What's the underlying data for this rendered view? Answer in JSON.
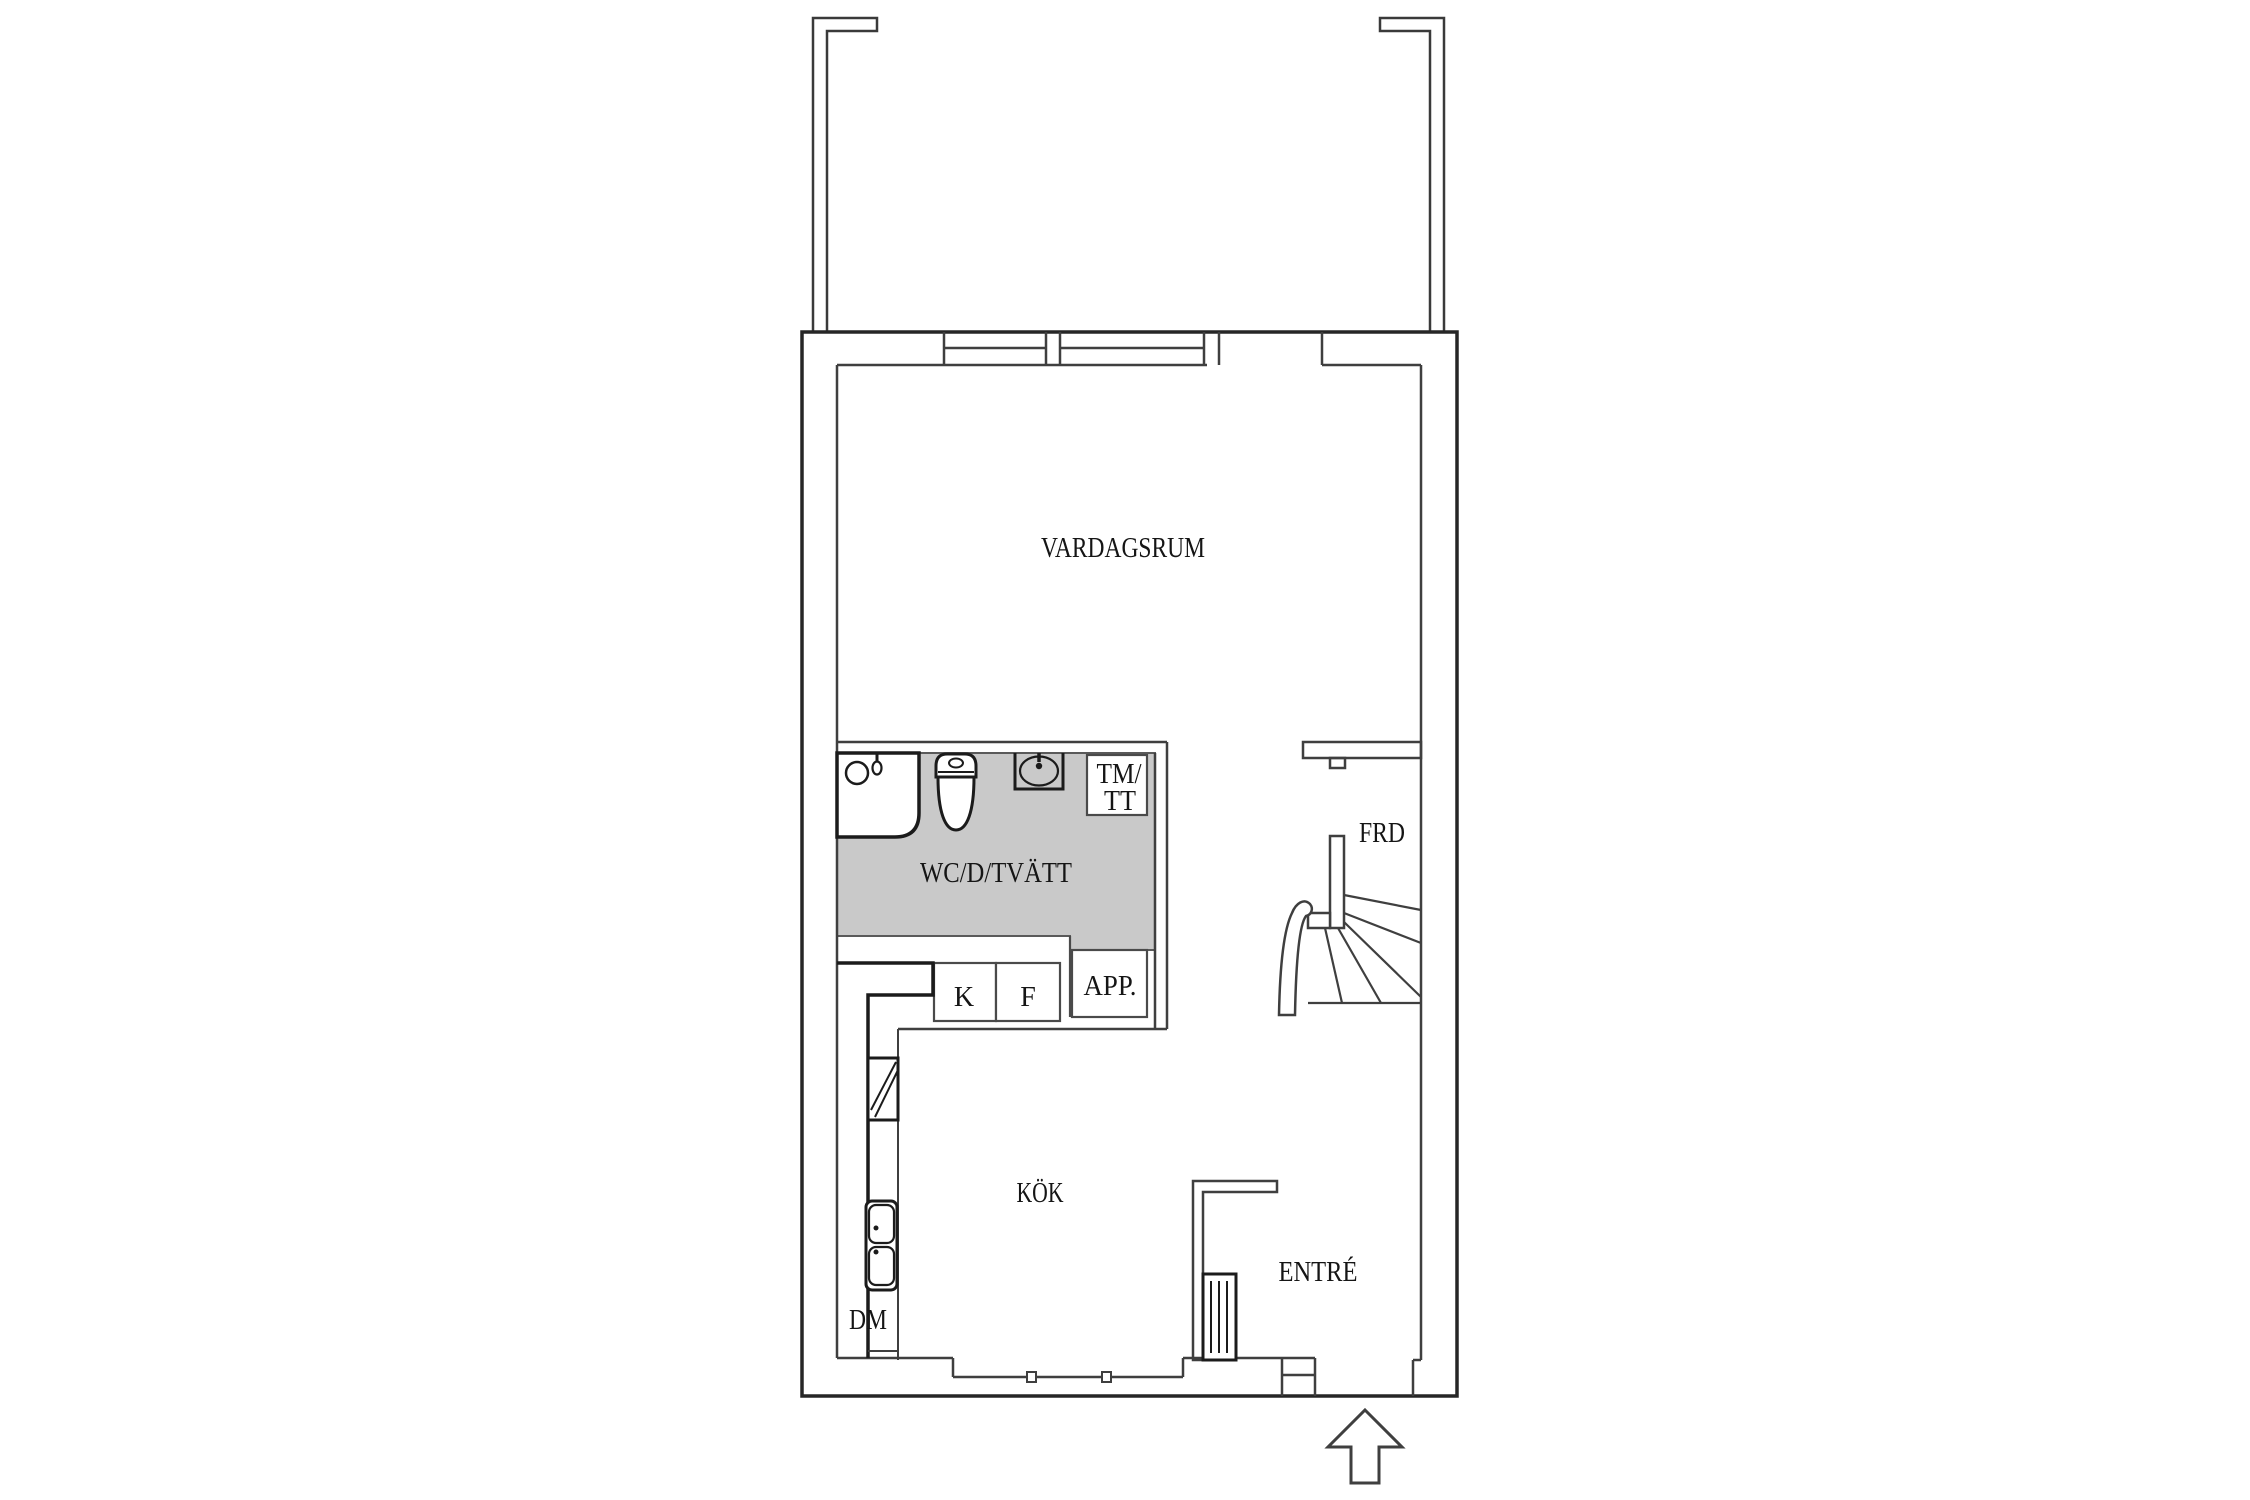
{
  "plan": {
    "type": "apartment-floor-plan",
    "language": "sv",
    "rooms": {
      "living_room": {
        "label": "VARDAGSRUM"
      },
      "wet_room": {
        "label": "WC/D/TVÄTT"
      },
      "storage": {
        "label": "FRD"
      },
      "kitchen": {
        "label": "KÖK"
      },
      "entrance": {
        "label": "ENTRÉ"
      }
    },
    "fixtures": {
      "washer_dryer_line1": "TM/",
      "washer_dryer_line2": "TT",
      "fridge": "K",
      "freezer": "F",
      "appliance_cabinet": "APP.",
      "dishwasher": "DM"
    },
    "icons": {
      "entrance_arrow": "up-arrow"
    },
    "colors": {
      "wet_room_fill": "#c9c9c9",
      "wall_line": "#3f3f3f",
      "outer_wall_line": "#262626",
      "fixture_line": "#1b1b1b",
      "label_text": "#151515",
      "background": "#ffffff"
    }
  }
}
